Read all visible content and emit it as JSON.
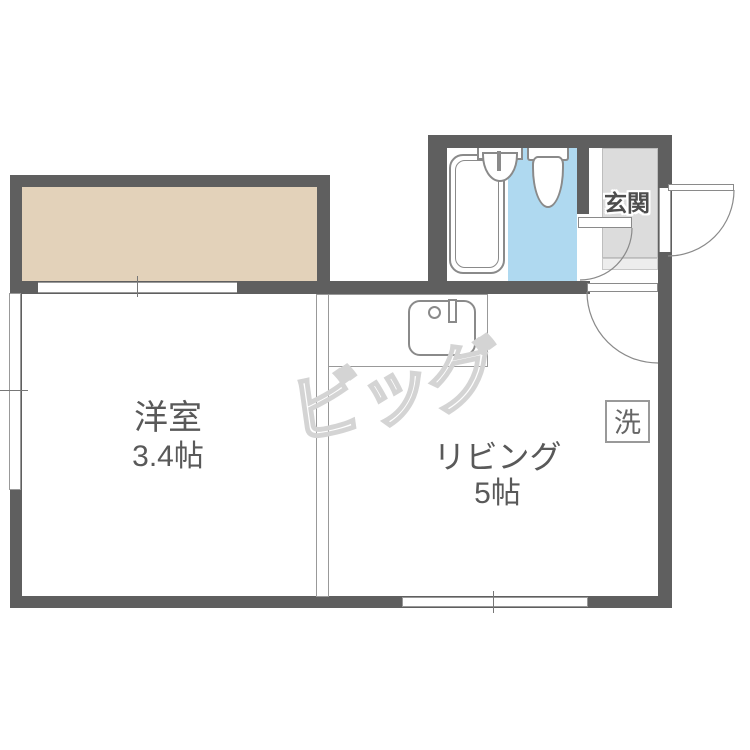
{
  "plan": {
    "type": "japanese-apartment-floorplan",
    "rooms": {
      "western": {
        "label": "洋室",
        "size": "3.4帖"
      },
      "living": {
        "label": "リビング",
        "size": "5帖"
      },
      "entrance": {
        "label": "玄関"
      },
      "washer": {
        "label": "洗"
      }
    },
    "fixtures": [
      "bathtub",
      "washbasin",
      "toilet",
      "kitchen-sink",
      "closet"
    ],
    "doors": [
      "front-door",
      "washroom-door",
      "living-room-door"
    ],
    "windows": [
      "left-window",
      "bottom-window",
      "closet-sliding-opening"
    ],
    "watermark": "ビッグ",
    "colors": {
      "wall": "#5F5F5F",
      "closet_floor": "#E3D2BA",
      "washroom_floor": "#AFD9F0",
      "entrance_floor": "#DCDCDC",
      "fixture_line": "#8A8A8A",
      "text": "#595959",
      "watermark_line": "#D4D4D4"
    }
  }
}
